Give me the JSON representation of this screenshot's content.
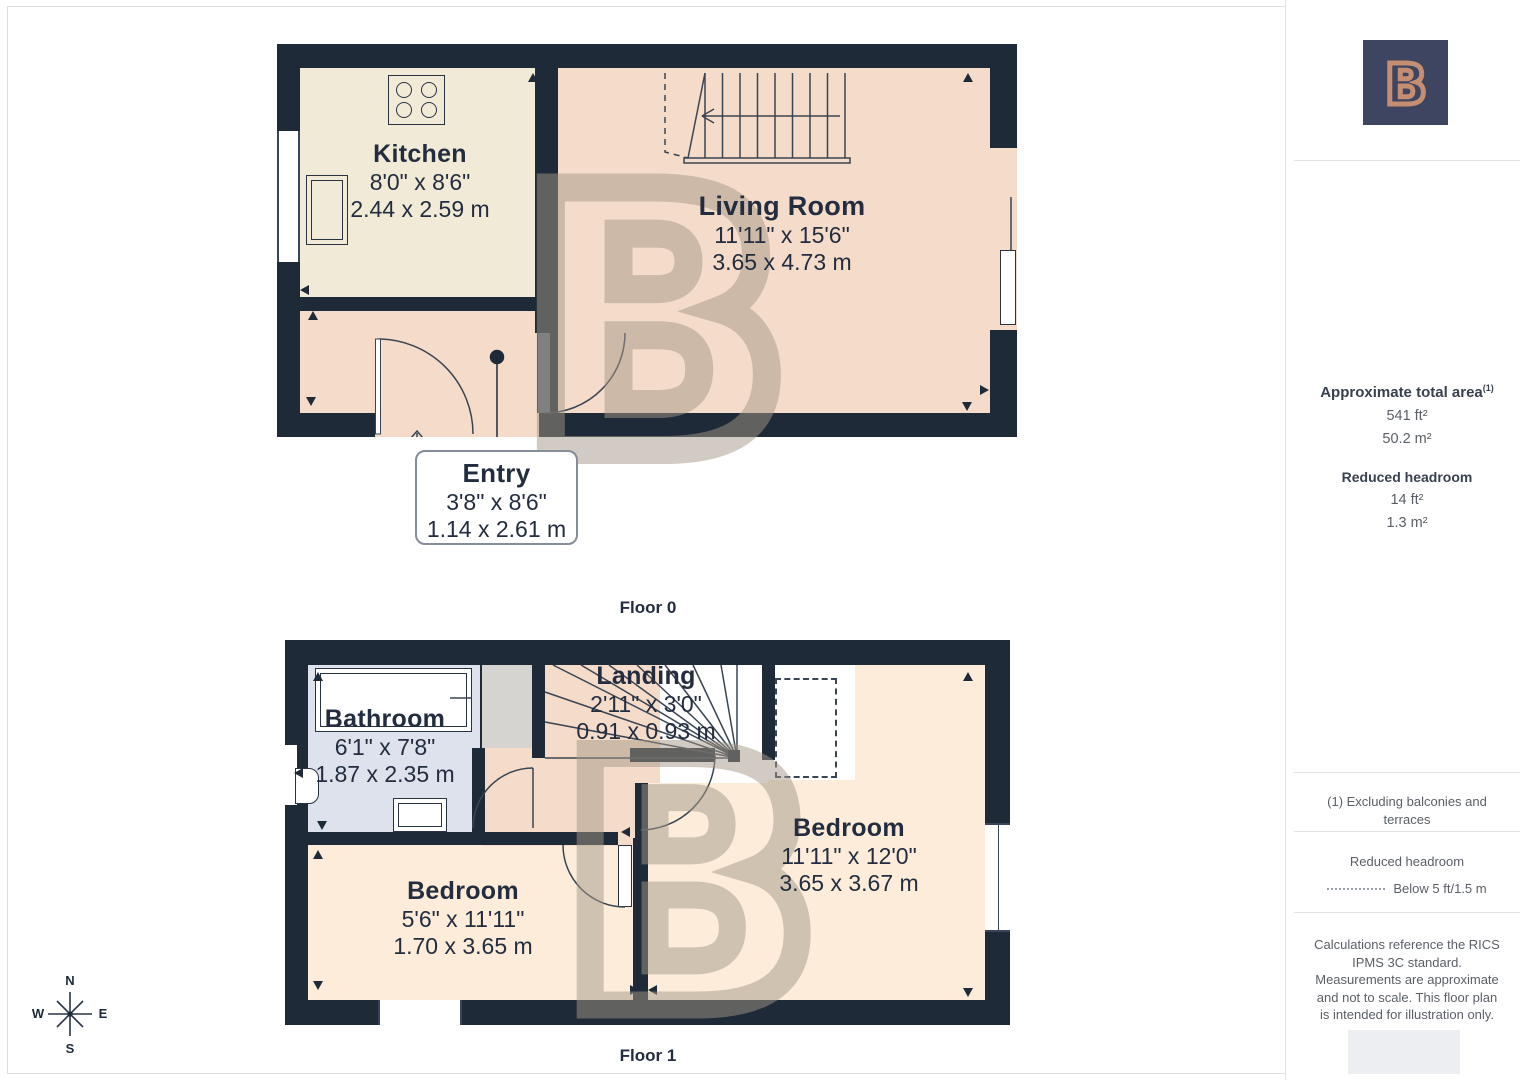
{
  "colors": {
    "wall": "#1f2a39",
    "kitchen_floor": "#f1ead6",
    "living_floor": "#f5dbc9",
    "bedroom_floor": "#fcecd9",
    "bathroom_floor": "#dde2ec",
    "brand_navy": "#3e4560",
    "brand_coral": "#c58d71"
  },
  "brand": {
    "logo_letter": "B"
  },
  "floor0": {
    "label": "Floor 0",
    "rooms": {
      "kitchen": {
        "name": "Kitchen",
        "dim_ft": "8'0\" x 8'6\"",
        "dim_m": "2.44 x 2.59 m"
      },
      "living": {
        "name": "Living Room",
        "dim_ft": "11'11\" x 15'6\"",
        "dim_m": "3.65 x 4.73 m"
      },
      "entry": {
        "name": "Entry",
        "dim_ft": "3'8\" x 8'6\"",
        "dim_m": "1.14 x 2.61 m"
      }
    }
  },
  "floor1": {
    "label": "Floor 1",
    "rooms": {
      "bathroom": {
        "name": "Bathroom",
        "dim_ft": "6'1\" x 7'8\"",
        "dim_m": "1.87 x 2.35 m"
      },
      "landing": {
        "name": "Landing",
        "dim_ft": "2'11\" x 3'0\"",
        "dim_m": "0.91 x 0.93 m"
      },
      "bedroom_right": {
        "name": "Bedroom",
        "dim_ft": "11'11\" x 12'0\"",
        "dim_m": "3.65 x 3.67 m"
      },
      "bedroom_left": {
        "name": "Bedroom",
        "dim_ft": "5'6\" x 11'11\"",
        "dim_m": "1.70 x 3.65 m"
      }
    }
  },
  "compass": {
    "n": "N",
    "s": "S",
    "e": "E",
    "w": "W"
  },
  "sidebar": {
    "area_title": "Approximate total area",
    "area_footnote_marker": "(1)",
    "area_ft": "541 ft²",
    "area_m": "50.2 m²",
    "headroom_title": "Reduced headroom",
    "headroom_ft": "14 ft²",
    "headroom_m": "1.3 m²",
    "note_excluding": "(1) Excluding balconies and terraces",
    "legend_title": "Reduced headroom",
    "legend_text": "Below 5 ft/1.5 m",
    "disclaimer": "Calculations reference the RICS IPMS 3C standard. Measurements are approximate and not to scale. This floor plan is intended for illustration only."
  }
}
